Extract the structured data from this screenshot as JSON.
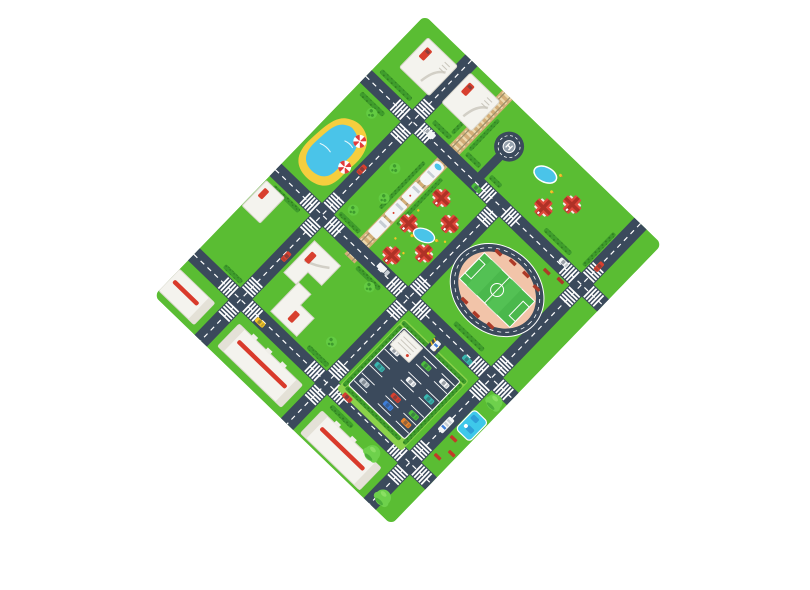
{
  "scene": {
    "type": "product-photo",
    "subject": "kids-city-traffic-play-mat",
    "background": "#ffffff",
    "mat_rotation_deg": 44
  },
  "colors": {
    "background": "#ffffff",
    "grass": "#5ABD33",
    "grass_light": "#8BD24A",
    "hedge": "#3F9D2C",
    "hedge_dark": "#2F7D1F",
    "road": "#3B4A5C",
    "road_line": "#FFFFFF",
    "track_bed": "#D3AE78",
    "track_tie": "#EDD8AC",
    "rail": "#9B8F6B",
    "water": "#4AC4E9",
    "sand": "#F5CE3E",
    "house_red": "#E0483B",
    "house_red_dark": "#AF3126",
    "plot_white": "#F4F3EE",
    "plot_line": "#D9D6CC",
    "office_line": "#C9C6BC",
    "stripe_red": "#D93A2B",
    "infield": "#F2C4A9",
    "pitch": "#4AB84C",
    "pitch_light": "#57C457",
    "bleacher": "#AD3A28",
    "bench": "#C23A28",
    "playground": "#3EC8EA",
    "playground_dark": "#2D9FD8",
    "tree": "#63CB42",
    "tree_dark": "#3E9B2E",
    "tree_big": "#6ED14C",
    "tree_big_base": "#4CAF3A",
    "taxi": "#F5C526",
    "car_red": "#D8402F",
    "car_teal": "#39B8B0",
    "car_green": "#4CBE3C",
    "car_blue": "#3D7DD8",
    "car_white": "#F4F6F7",
    "car_silver": "#C8CFD6",
    "car_orange": "#E8842C",
    "train_gray": "#C6CDD4",
    "duck": "#F5C526",
    "duck_beak": "#E8842C",
    "parasol_red": "#E23B3B",
    "helipad_pad": "#94A0AC"
  },
  "mat": {
    "features": [
      {
        "name": "beach-pond-with-sand"
      },
      {
        "name": "beach-parasol",
        "count": 2
      },
      {
        "name": "driveway-plot-with-red-car",
        "count": 5
      },
      {
        "name": "helipad"
      },
      {
        "name": "kidney-pool",
        "count": 2
      },
      {
        "name": "railway-with-train",
        "train_cars": 4
      },
      {
        "name": "red-house",
        "count": 7
      },
      {
        "name": "duck",
        "count": 4
      },
      {
        "name": "stadium-soccer-field"
      },
      {
        "name": "bleacher",
        "count": 9
      },
      {
        "name": "parking-lot",
        "parked_cars": 12
      },
      {
        "name": "apartment-block",
        "count": 3
      },
      {
        "name": "playground"
      },
      {
        "name": "bench",
        "count": 3
      },
      {
        "name": "zebra-crossing-intersection",
        "count": 9
      },
      {
        "name": "hedge-strip",
        "count": 17
      },
      {
        "name": "tree",
        "count": 9
      }
    ],
    "roads": {
      "horizontal": 3,
      "vertical": 3
    },
    "vehicles_on_roads": [
      "green-car",
      "white-van",
      "white-truck",
      "teal-car",
      "red-car",
      "yellow-taxi",
      "white-bus",
      "police-car"
    ]
  }
}
